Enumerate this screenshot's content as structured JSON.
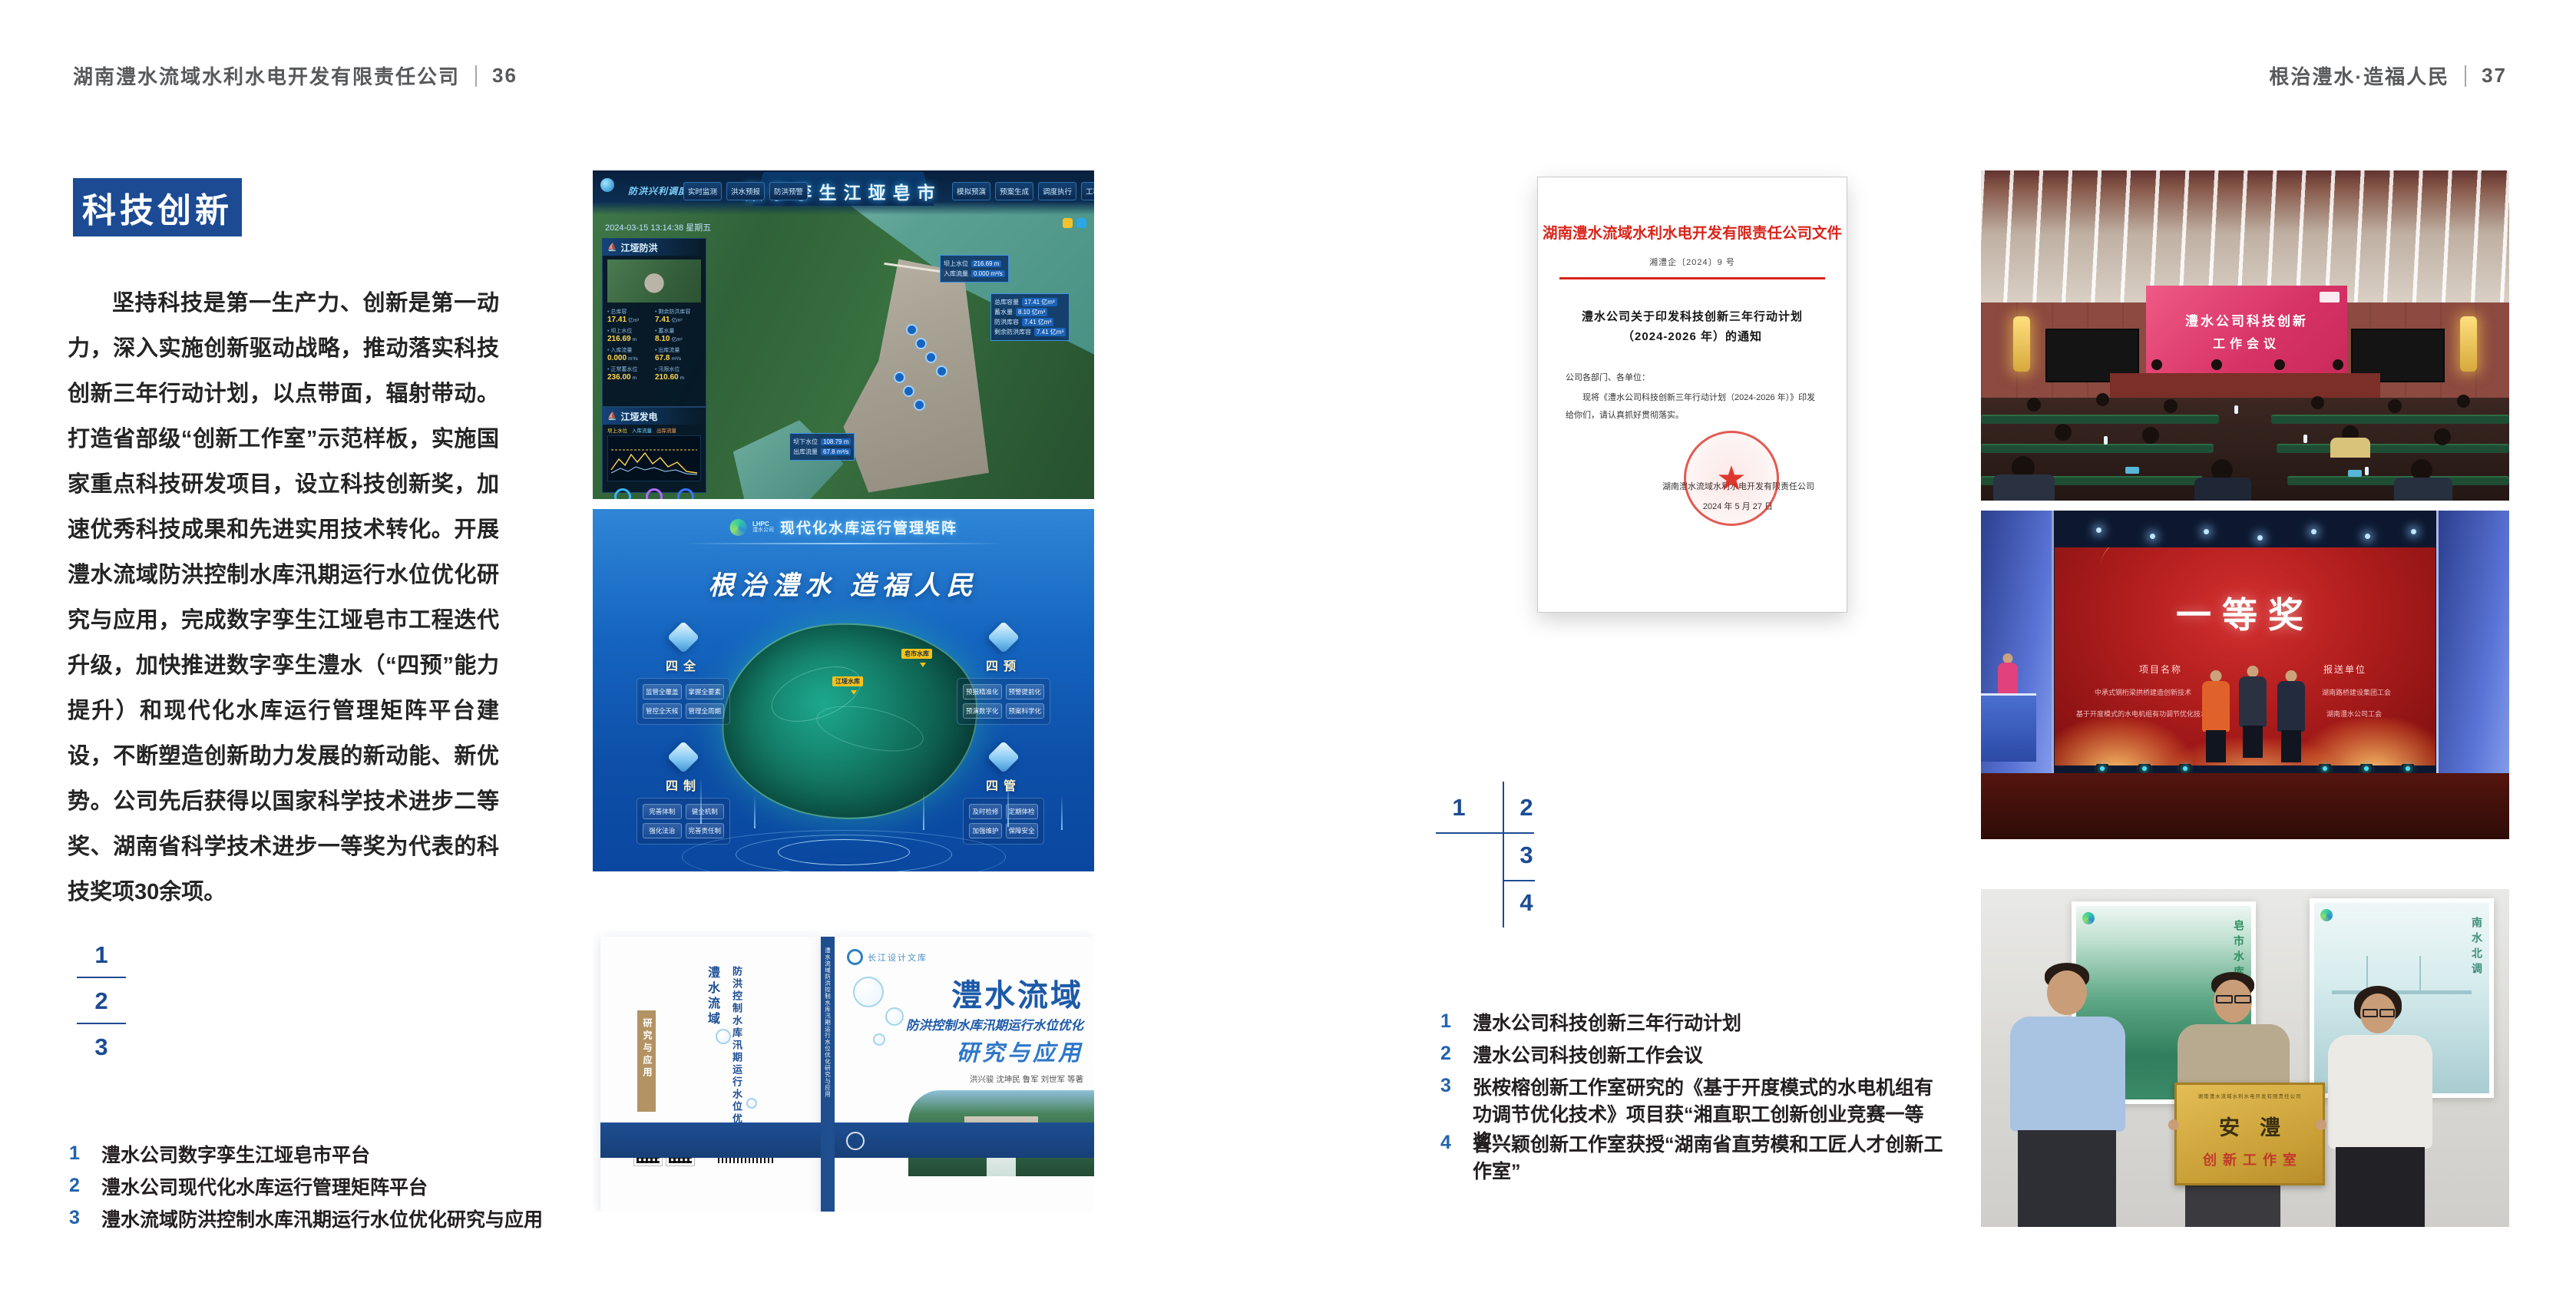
{
  "accent": "#1c4b94",
  "page_left": {
    "header": "湖南澧水流域水利水电开发有限责任公司",
    "page_no": "36",
    "section_title": "科技创新",
    "body": "坚持科技是第一生产力、创新是第一动力，深入实施创新驱动战略，推动落实科技创新三年行动计划，以点带面，辐射带动。打造省部级“创新工作室”示范样板，实施国家重点科技研发项目，设立科技创新奖，加速优秀科技成果和先进实用技术转化。开展澧水流域防洪控制水库汛期运行水位优化研究与应用，完成数字孪生江垭皂市工程迭代升级，加快推进数字孪生澧水（“四预”能力提升）和现代化水库运行管理矩阵平台建设，不断塑造创新助力发展的新动能、新优势。公司先后获得以国家科学技术进步二等奖、湖南省科学技术进步一等奖为代表的科技奖项30余项。",
    "markers": [
      "1",
      "2",
      "3"
    ],
    "captions": [
      {
        "num": "1",
        "text": "澧水公司数字孪生江垭皂市平台"
      },
      {
        "num": "2",
        "text": "澧水公司现代化水库运行管理矩阵平台"
      },
      {
        "num": "3",
        "text": "澧水流域防洪控制水库汛期运行水位优化研究与应用"
      }
    ]
  },
  "page_right": {
    "header": "根治澧水·造福人民",
    "page_no": "37",
    "markers": [
      "1",
      "2",
      "3",
      "4"
    ],
    "captions": [
      {
        "num": "1",
        "text": "澧水公司科技创新三年行动计划"
      },
      {
        "num": "2",
        "text": "澧水公司科技创新工作会议"
      },
      {
        "num": "3",
        "text": "张桉榕创新工作室研究的《基于开度模式的水电机组有功调节优化技术》项目获“湘直职工创新创业竞赛一等奖”"
      },
      {
        "num": "4",
        "text": "曾兴颖创新工作室获授“湖南省直劳模和工匠人才创新工作室”"
      }
    ]
  },
  "dashboard": {
    "title": "数字孪生江垭皂市",
    "nav_prefix": "防洪兴利调度",
    "nav_left": [
      "实时监测",
      "洪水预报",
      "防洪预警"
    ],
    "nav_right": [
      "模拟预演",
      "预案生成",
      "调度执行",
      "工程巡检"
    ],
    "datetime": "2024-03-15 13:14:38 星期五",
    "panel_flood": {
      "title": "江垭防洪",
      "stats": [
        {
          "l": "总库容",
          "v": "17.41",
          "u": "亿m³"
        },
        {
          "l": "剩余防洪库容",
          "v": "7.41",
          "u": "亿m³"
        },
        {
          "l": "坝上水位",
          "v": "216.69",
          "u": "m"
        },
        {
          "l": "蓄水量",
          "v": "8.10",
          "u": "亿m³"
        },
        {
          "l": "入库流量",
          "v": "0.000",
          "u": "m³/s"
        },
        {
          "l": "出库流量",
          "v": "67.8",
          "u": "m³/s"
        },
        {
          "l": "正常蓄水位",
          "v": "236.00",
          "u": "m"
        },
        {
          "l": "汛限水位",
          "v": "210.60",
          "u": "m"
        }
      ],
      "legend": [
        "坝上水位",
        "入库流量",
        "出库流量"
      ]
    },
    "panel_power": {
      "title": "江垭发电",
      "stats": [
        {
          "l": "年发电计划",
          "v": "6.3000",
          "u": "亿度"
        },
        {
          "l": "年累计发电量",
          "v": "1.2907",
          "u": "亿度"
        },
        {
          "l": "月累计发电量",
          "v": "3359.21",
          "u": "万度"
        },
        {
          "l": "当前出力",
          "v": "0.00",
          "u": "MW"
        },
        {
          "l": "发电流量",
          "v": "0.00",
          "u": "m³/s"
        },
        {
          "l": "弃水流量",
          "v": "0.00",
          "u": "m³/s"
        }
      ]
    },
    "tip_up": [
      {
        "l": "坝上水位",
        "v": "216.69 m"
      },
      {
        "l": "入库流量",
        "v": "0.000 m³/s"
      }
    ],
    "tip_cap": [
      {
        "l": "总库容量",
        "v": "17.41 亿m³"
      },
      {
        "l": "蓄水量",
        "v": "8.10 亿m³"
      },
      {
        "l": "防洪库容",
        "v": "7.41 亿m³"
      },
      {
        "l": "剩余防洪库容",
        "v": "7.41 亿m³"
      }
    ],
    "tip_down": [
      {
        "l": "坝下水位",
        "v": "108.79 m"
      },
      {
        "l": "出库流量",
        "v": "67.8 m³/s"
      }
    ]
  },
  "matrix": {
    "logo_line1": "LHPC",
    "logo_line2": "澧水公司",
    "title": "现代化水库运行管理矩阵",
    "slogan": "根治澧水 造福人民",
    "groups": [
      {
        "name": "四全",
        "tags": [
          "监管全覆盖",
          "掌握全要素",
          "管控全天候",
          "管理全周期"
        ]
      },
      {
        "name": "四预",
        "tags": [
          "预报精准化",
          "预警提前化",
          "预演数字化",
          "预案科学化"
        ]
      },
      {
        "name": "四制",
        "tags": [
          "完善体制",
          "健全机制",
          "强化法治",
          "完善责任制"
        ]
      },
      {
        "name": "四管",
        "tags": [
          "及时检修",
          "定期体检",
          "加强维护",
          "保障安全"
        ]
      }
    ],
    "map_labels": [
      "江垭水库",
      "皂市水库"
    ]
  },
  "book": {
    "brand": "长江设计文库",
    "title": "澧水流域",
    "subtitle": "防洪控制水库汛期运行水位优化",
    "tail": "研究与应用",
    "authors": "洪兴骏 沈坤民 鲁军 刘世军 等著",
    "spine": "澧水流域防洪控制水库汛期运行水位优化研究与应用",
    "back_title": "澧水流域",
    "back_subtitle": "防洪控制水库汛期运行水位优化",
    "back_tail": "研究与应用"
  },
  "document": {
    "title": "湖南澧水流域水利水电开发有限责任公司文件",
    "doc_no": "湘澧企〔2024〕9 号",
    "subject1": "澧水公司关于印发科技创新三年行动计划",
    "subject2": "（2024-2026 年）的通知",
    "salutation": "公司各部门、各单位：",
    "body": "现将《澧水公司科技创新三年行动计划（2024-2026 年）》印发给你们，请认真抓好贯彻落实。",
    "signer": "湖南澧水流域水利水电开发有限责任公司",
    "date": "2024 年 5 月 27 日"
  },
  "meeting": {
    "screen1": "澧水公司科技创新",
    "screen2": "工作会议"
  },
  "award": {
    "title": "一等奖",
    "col1_header": "项目名称",
    "col2_header": "报送单位",
    "col1_rows": [
      "中承式钢桁梁拱桥建造创新技术",
      "基于开度模式的水电机组有功调节优化技术"
    ],
    "col2_rows": [
      "湖南路桥建设集团工会",
      "湖南澧水公司工会"
    ]
  },
  "plaque": {
    "header": "湖南澧水流域水利水电开发有限责任公司",
    "title": "安澧",
    "subtitle": "创新工作室",
    "poster_left": "皂市水库",
    "poster_right": "南水北调"
  }
}
